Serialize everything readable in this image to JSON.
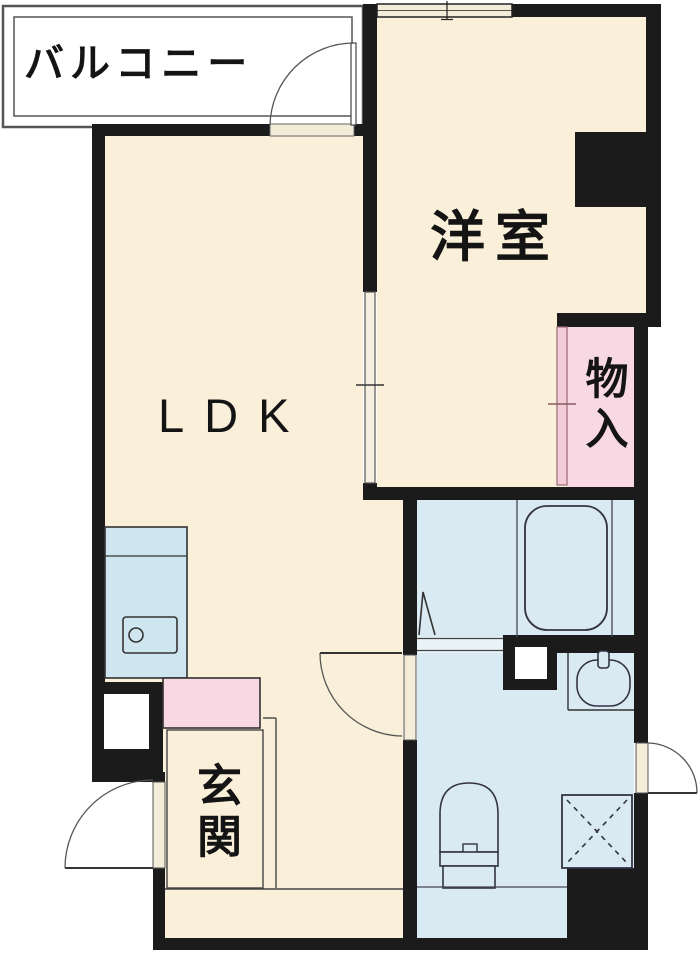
{
  "plan": {
    "title": "1LDK apartment floor plan",
    "rooms": {
      "balcony": {
        "label": "バルコニー"
      },
      "western_room": {
        "label": "洋室"
      },
      "ldk": {
        "label": "LDK"
      },
      "storage": {
        "label": "物入"
      },
      "entrance": {
        "label": "玄関"
      }
    },
    "fixtures": [
      "kitchen-unit",
      "kitchen-sink",
      "faucet",
      "bathtub",
      "folding-bath-door",
      "washbasin",
      "toilet",
      "washing-machine-pan",
      "meter-box",
      "shoe-cabinet",
      "entrance-step",
      "pillar",
      "pipe-space"
    ],
    "doors": [
      "balcony-swing-door",
      "entrance-swing-door",
      "washroom-swing-door",
      "right-side-swing-door",
      "sliding-door-ldk-western-room",
      "sliding-door-storage"
    ],
    "colors": {
      "wall": "#1b1b1b",
      "room_floor_beige": "#faf0da",
      "wet_area_blue": "#d9eaf3",
      "storage_pink": "#f8d8e2",
      "kitchen_blue": "#cfe6f0",
      "door_frame_tan": "#f2ecd9",
      "thin_line": "#333333",
      "background": "#ffffff"
    }
  }
}
